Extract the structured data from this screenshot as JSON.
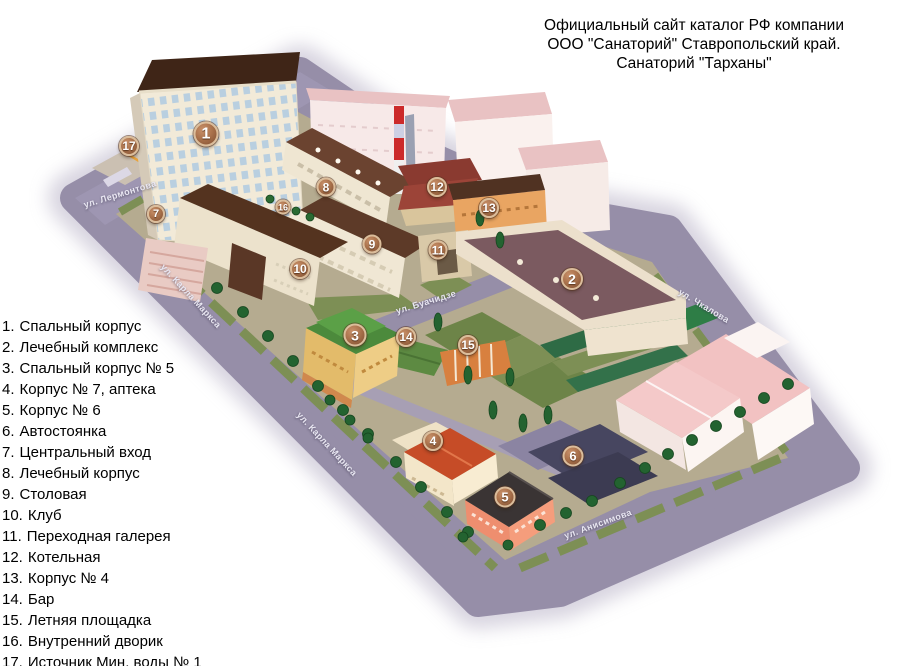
{
  "title": {
    "lines": [
      "Официальный сайт каталог РФ компании",
      "ООО \"Санаторий\" Ставропольский край.",
      "Санаторий \"Тарханы\""
    ]
  },
  "legend": {
    "items": [
      {
        "num": "1.",
        "label": "Спальный корпус"
      },
      {
        "num": "2.",
        "label": "Лечебный комплекс"
      },
      {
        "num": "3.",
        "label": "Спальный корпус № 5"
      },
      {
        "num": "4.",
        "label": "Корпус № 7, аптека"
      },
      {
        "num": "5.",
        "label": "Корпус № 6"
      },
      {
        "num": "6.",
        "label": "Автостоянка"
      },
      {
        "num": "7.",
        "label": "Центральный вход"
      },
      {
        "num": "8.",
        "label": "Лечебный корпус"
      },
      {
        "num": "9.",
        "label": "Столовая"
      },
      {
        "num": "10.",
        "label": "Клуб"
      },
      {
        "num": "11.",
        "label": "Переходная галерея"
      },
      {
        "num": "12.",
        "label": "Котельная"
      },
      {
        "num": "13.",
        "label": "Корпус № 4"
      },
      {
        "num": "14.",
        "label": "Бар"
      },
      {
        "num": "15.",
        "label": "Летняя площадка"
      },
      {
        "num": "16.",
        "label": "Внутренний дворик"
      },
      {
        "num": "17.",
        "label": "Источник Мин. воды № 1"
      }
    ]
  },
  "map": {
    "markers": [
      {
        "n": "1",
        "x": 206,
        "y": 134,
        "d": 25
      },
      {
        "n": "2",
        "x": 572,
        "y": 279,
        "d": 22
      },
      {
        "n": "3",
        "x": 355,
        "y": 335,
        "d": 23
      },
      {
        "n": "4",
        "x": 433,
        "y": 441,
        "d": 20
      },
      {
        "n": "5",
        "x": 505,
        "y": 497,
        "d": 21
      },
      {
        "n": "6",
        "x": 573,
        "y": 456,
        "d": 21
      },
      {
        "n": "7",
        "x": 156,
        "y": 214,
        "d": 18
      },
      {
        "n": "8",
        "x": 326,
        "y": 187,
        "d": 19
      },
      {
        "n": "9",
        "x": 372,
        "y": 244,
        "d": 19
      },
      {
        "n": "10",
        "x": 300,
        "y": 269,
        "d": 20
      },
      {
        "n": "11",
        "x": 438,
        "y": 250,
        "d": 19
      },
      {
        "n": "12",
        "x": 437,
        "y": 187,
        "d": 20
      },
      {
        "n": "13",
        "x": 489,
        "y": 208,
        "d": 20
      },
      {
        "n": "14",
        "x": 406,
        "y": 337,
        "d": 20
      },
      {
        "n": "15",
        "x": 468,
        "y": 345,
        "d": 20
      },
      {
        "n": "16",
        "x": 283,
        "y": 207,
        "d": 15
      },
      {
        "n": "17",
        "x": 129,
        "y": 146,
        "d": 20
      }
    ],
    "streets": [
      {
        "name": "ул. Лермонтова",
        "x": 120,
        "y": 194,
        "angle": -17
      },
      {
        "name": "ул. Карла Маркса",
        "x": 191,
        "y": 296,
        "angle": 47
      },
      {
        "name": "ул. Карла Маркса",
        "x": 327,
        "y": 444,
        "angle": 47
      },
      {
        "name": "ул. Буачидзе",
        "x": 426,
        "y": 302,
        "angle": -17
      },
      {
        "name": "ул. Чкалова",
        "x": 704,
        "y": 306,
        "angle": 31
      },
      {
        "name": "ул. Анисимова",
        "x": 598,
        "y": 524,
        "angle": -20
      }
    ]
  },
  "palette": {
    "road": "#968ea8",
    "roadLight": "#a59dbb",
    "ground": "#b5ab90",
    "grass": "#7d8f55",
    "grass2": "#6d8448",
    "hedge": "#2e6b45",
    "hedge2": "#33714a",
    "greenRoof": "#2e7d46",
    "roofDark": "#3f2517",
    "roofMid": "#6b4330",
    "mauve": "#7b5a60",
    "pinkRoof": "#e9c2c3",
    "pinkRoof2": "#f4c9c9",
    "wallCream": "#f2ead8",
    "green3": "#4c8a3c",
    "yellow3": "#e3bb6a",
    "orange15": "#d8803f",
    "orangeWall": "#e9a562",
    "red4": "#c64c27",
    "salmon": "#ee8e6f",
    "parkingDark": "#474660",
    "chimneyRed": "#cc2a2a",
    "treeDark": "#236330",
    "markerRim": "#dbbd9b"
  }
}
